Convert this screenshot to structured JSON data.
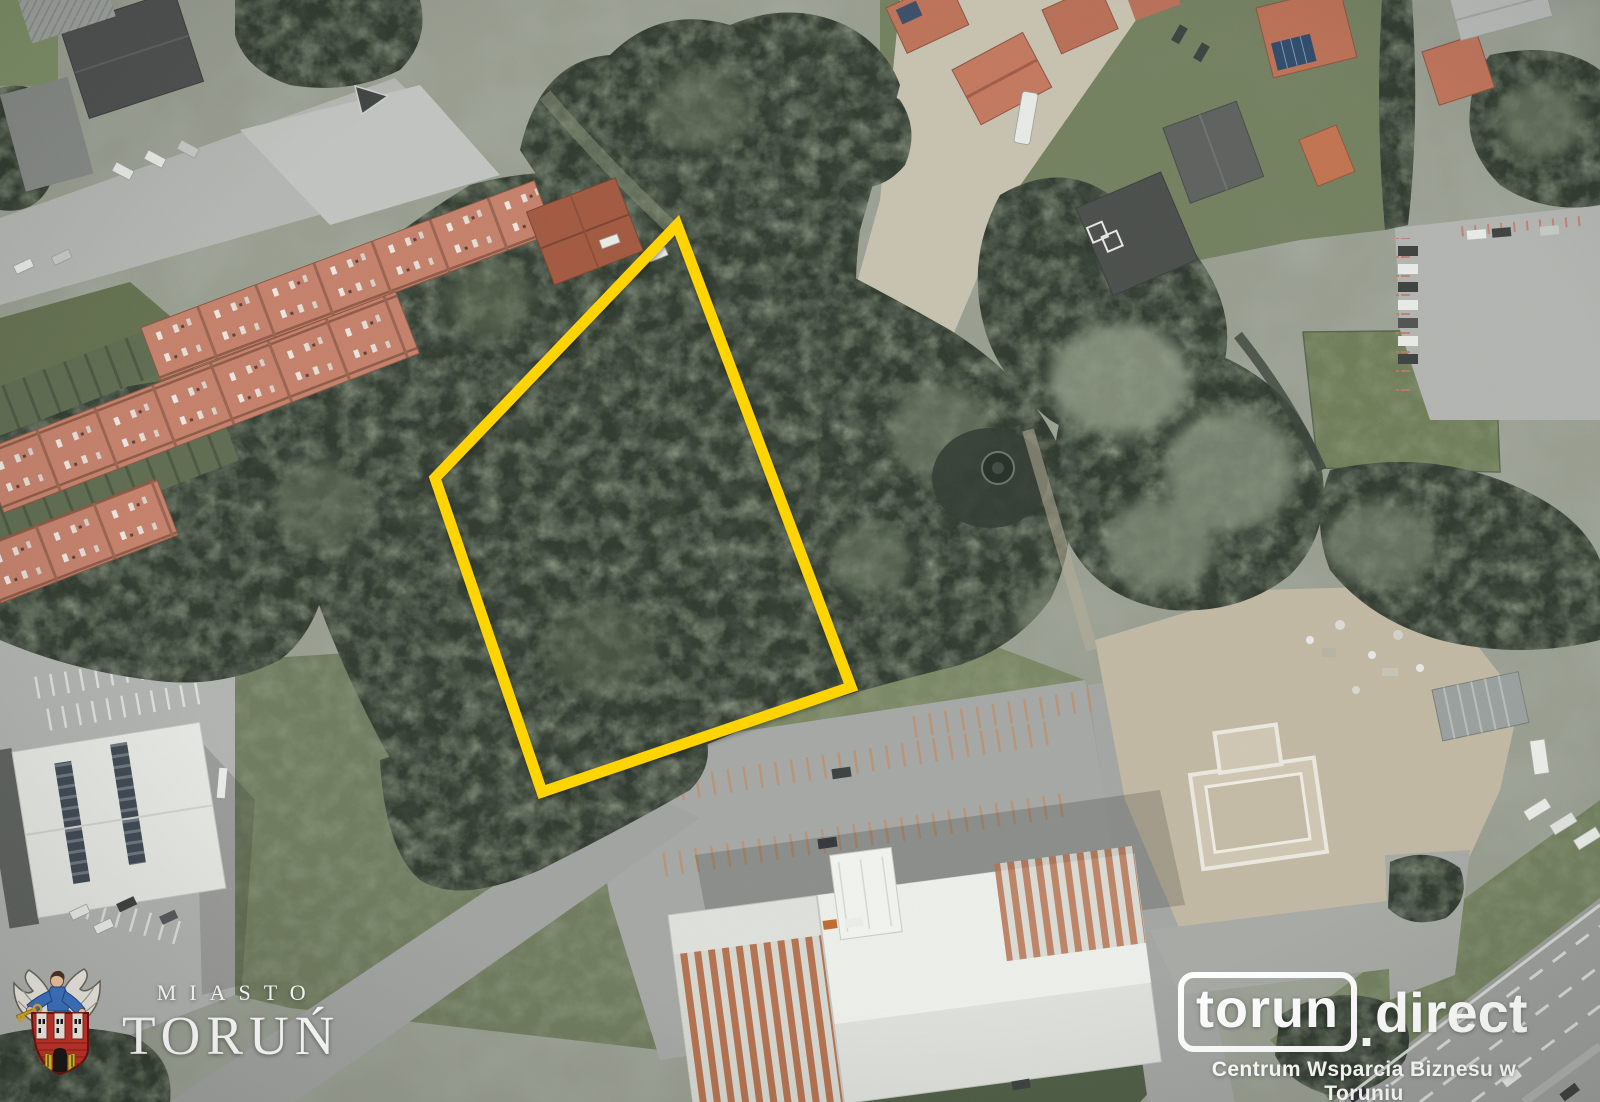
{
  "map": {
    "type": "aerial-orthophoto",
    "parcel_outline": {
      "points": "677,225 435,478 542,792 851,687",
      "color": "#ffd400",
      "stroke_width": 11
    }
  },
  "branding": {
    "city_logo": {
      "icon": "torun-coat-of-arms",
      "top_text": "MIASTO",
      "bottom_text": "TORUŃ"
    },
    "business_center_logo": {
      "boxed_text": "torun",
      "dot": ".",
      "suffix_text": "direct",
      "tagline": "Centrum Wsparcia Biznesu w Toruniu"
    }
  },
  "palette": {
    "parcel_yellow": "#ffd400",
    "logo_white": "#ffffff",
    "forest_dark_green": "#2f392e",
    "roof_terracotta": "#c5816b",
    "pavement_gray": "#a7a9a5",
    "sand_tan": "#c6bdaa"
  }
}
